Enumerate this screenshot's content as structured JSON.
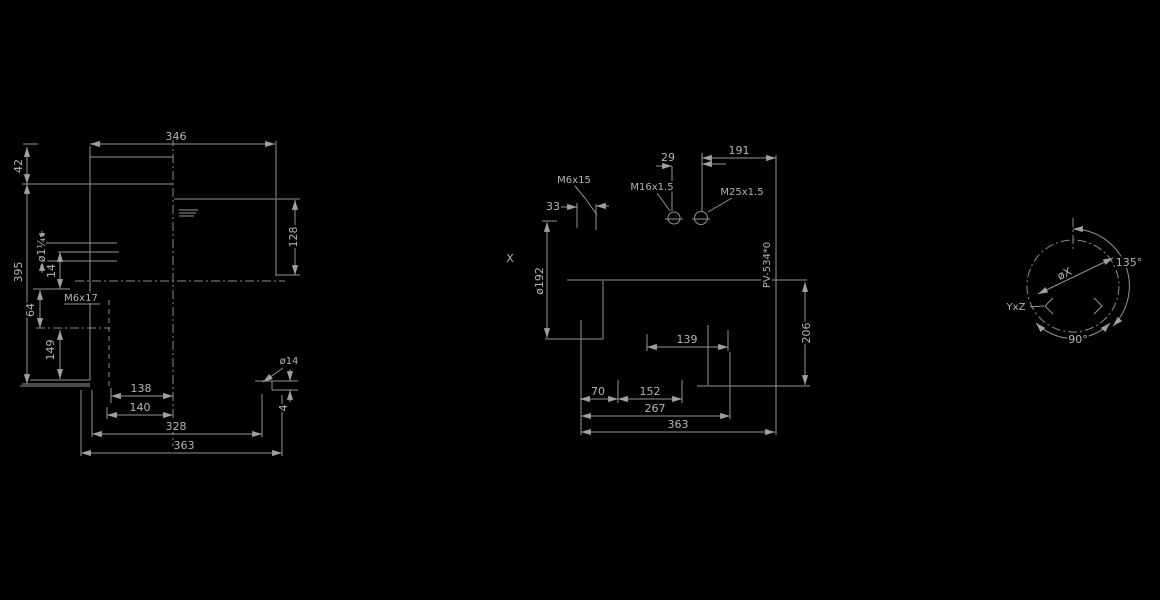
{
  "drawing": {
    "background": "#000000",
    "line_color": "#949494",
    "text_color": "#b4b4b4",
    "side_view": {
      "width_top": "346",
      "h42": "42",
      "h395": "395",
      "h128": "128",
      "port": "ø1¼",
      "o14": "14",
      "thread": "M6x17",
      "o64": "64",
      "o149": "149",
      "s138": "138",
      "s140": "140",
      "s328": "328",
      "s363": "363",
      "hole": "ø14",
      "pad": "4"
    },
    "front_view": {
      "o29": "29",
      "o191": "191",
      "m6": "M6x15",
      "m16": "M16x1.5",
      "m25": "M25x1.5",
      "o33": "33",
      "x_label": "X",
      "dia": "ø192",
      "part": "PV-534*0",
      "o206": "206",
      "o139": "139",
      "o70": "70",
      "o152": "152",
      "o267": "267",
      "o363": "363"
    },
    "flange_view": {
      "a135": "135°",
      "a90": "90°",
      "diax": "øX",
      "holes": "YxZ"
    }
  }
}
